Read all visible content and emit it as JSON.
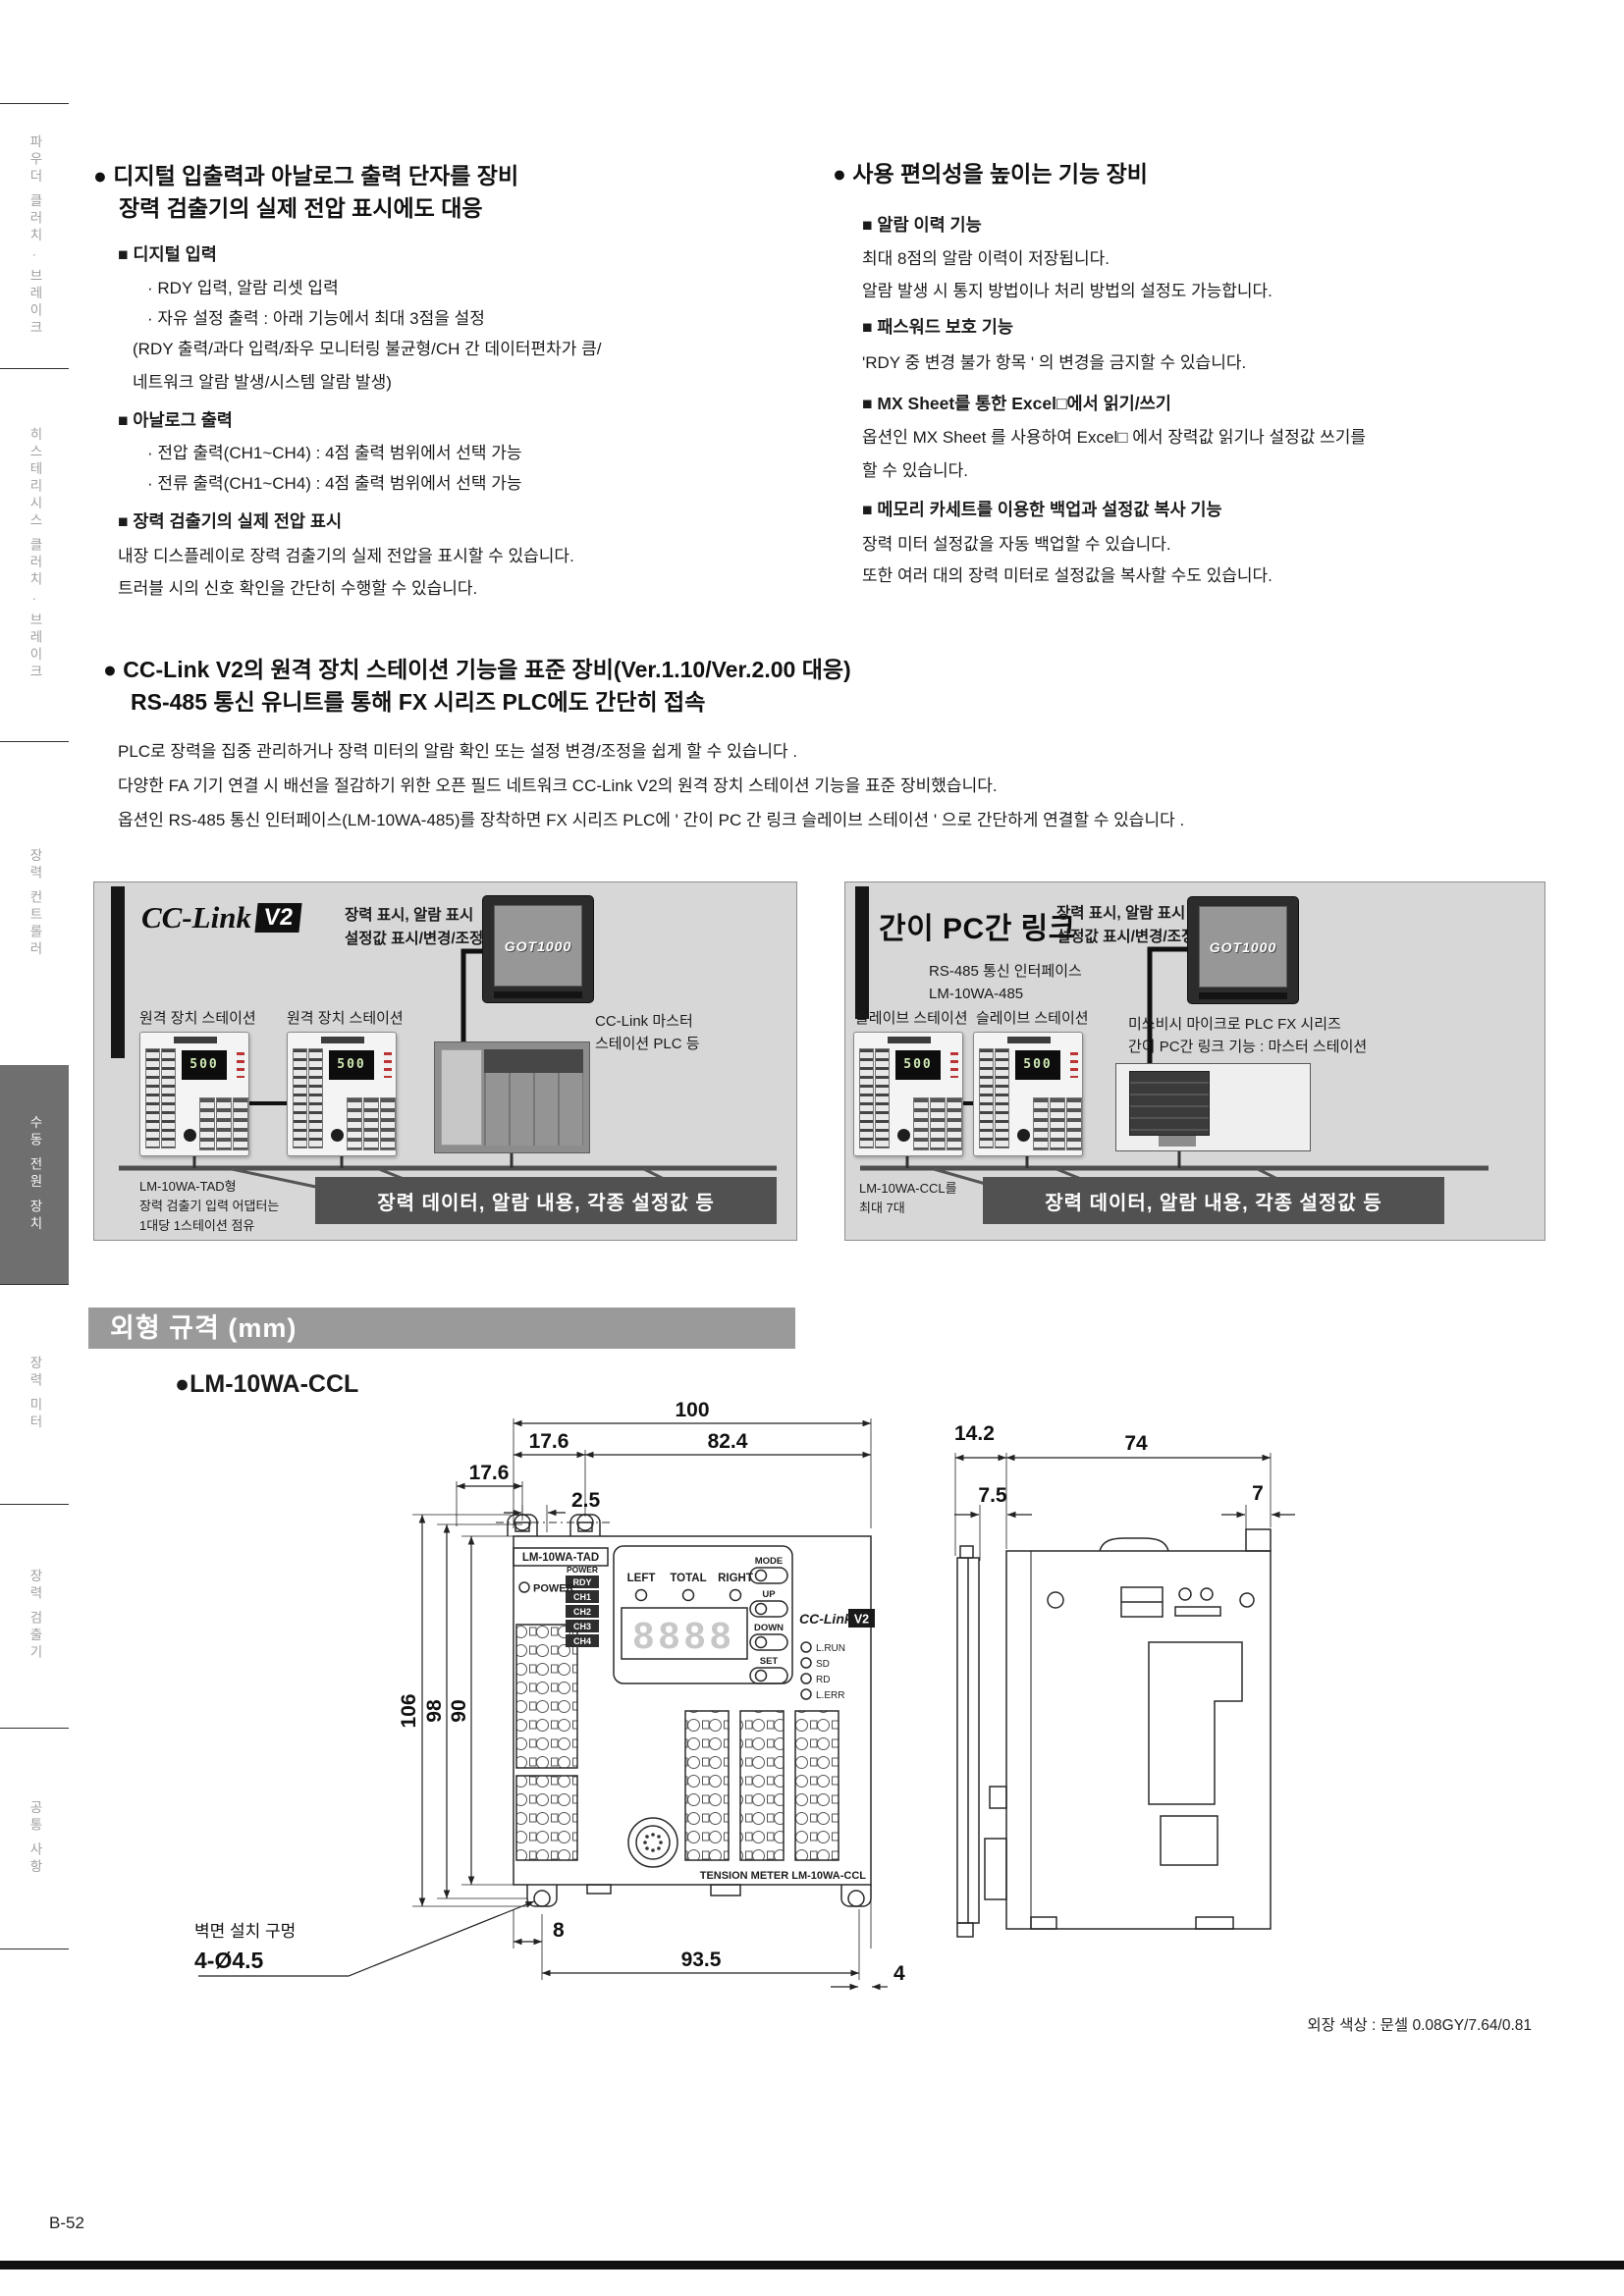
{
  "sidebar": {
    "tabs": [
      {
        "label": "파우더 클러치 · 브레이크"
      },
      {
        "label": "히스테리시스 클러치 · 브레이크"
      },
      {
        "label": "장력 컨트롤러"
      },
      {
        "label": "수동 전원 장치"
      },
      {
        "label": "장력 미터"
      },
      {
        "label": "장력 검출기"
      },
      {
        "label": "공통 사항"
      }
    ]
  },
  "features_left": {
    "title1": "● 디지털 입출력과 아날로그 출력 단자를 장비",
    "title2": "장력 검출기의 실제 전압 표시에도 대응",
    "digital_header": "■ 디지털 입력",
    "digital_item1": "· RDY 입력, 알람 리셋 입력",
    "digital_item2": "· 자유 설정 출력 : 아래 기능에서 최대 3점을 설정",
    "digital_item3": "(RDY 출력/과다 입력/좌우 모니터링 불균형/CH 간 데이터편차가 큼/",
    "digital_item4": "네트워크 알람 발생/시스템 알람 발생)",
    "analog_header": "■ 아날로그 출력",
    "analog_item1": "· 전압 출력(CH1~CH4) : 4점 출력 범위에서 선택 가능",
    "analog_item2": "· 전류 출력(CH1~CH4) : 4점 출력 범위에서 선택 가능",
    "voltage_header": "■ 장력 검출기의 실제 전압 표시",
    "voltage_line1": "내장 디스플레이로 장력 검출기의 실제 전압을 표시할 수 있습니다.",
    "voltage_line2": "트러블 시의 신호 확인을 간단히 수행할 수 있습니다."
  },
  "features_right": {
    "title": "● 사용 편의성을 높이는 기능 장비",
    "b1_header": "■ 알람 이력 기능",
    "b1_line1": "최대 8점의 알람 이력이 저장됩니다.",
    "b1_line2": "알람 발생 시 통지 방법이나 처리 방법의 설정도 가능합니다.",
    "b2_header": "■ 패스워드 보호 기능",
    "b2_line1": "'RDY 중 변경 불가 항목 ' 의 변경을 금지할 수 있습니다.",
    "b3_header": "■ MX Sheet를 통한 Excel□에서 읽기/쓰기",
    "b3_line1": "옵션인 MX Sheet 를 사용하여 Excel□ 에서 장력값 읽기나 설정값 쓰기를",
    "b3_line2": "할 수 있습니다.",
    "b4_header": "■ 메모리 카세트를 이용한 백업과 설정값 복사 기능",
    "b4_line1": "장력 미터 설정값을 자동 백업할 수 있습니다.",
    "b4_line2": "또한 여러 대의 장력 미터로 설정값을 복사할 수도 있습니다."
  },
  "cclink_section": {
    "title1": "● CC-Link V2의 원격 장치 스테이션 기능을 표준 장비(Ver.1.10/Ver.2.00 대응)",
    "title2": "RS-485 통신 유니트를 통해 FX 시리즈 PLC에도 간단히 접속",
    "p1": "PLC로 장력을 집중 관리하거나 장력 미터의 알람 확인 또는 설정 변경/조정을 쉽게 할 수 있습니다 .",
    "p2": "다양한 FA 기기 연결 시 배선을 절감하기 위한 오픈 필드 네트워크 CC-Link V2의 원격 장치 스테이션 기능을 표준 장비했습니다.",
    "p3": "옵션인 RS-485 통신 인터페이스(LM-10WA-485)를 장착하면 FX 시리즈 PLC에 ' 간이 PC 간 링크 슬레이브 스테이션 ' 으로 간단하게 연결할 수 있습니다 ."
  },
  "diagram_cclink": {
    "logo": "CC-Link",
    "logo_badge": "V2",
    "caption1": "장력 표시, 알람 표시",
    "caption2": "설정값 표시/변경/조정 등",
    "got_label": "GOT1000",
    "station1": "원격 장치 스테이션",
    "station2": "원격 장치 스테이션",
    "display": "500",
    "master1": "CC-Link 마스터",
    "master2": "스테이션 PLC 등",
    "note1": "LM-10WA-TAD형",
    "note2": "장력 검출기 입력 어댑터는",
    "note3": "1대당 1스테이션 점유",
    "banner": "장력 데이터, 알람 내용, 각종 설정값 등"
  },
  "diagram_pclink": {
    "title": "간이 PC간 링크",
    "caption1": "장력 표시, 알람 표시",
    "caption2": "설정값 표시/변경/조정 등",
    "got_label": "GOT1000",
    "interface1": "RS-485 통신 인터페이스",
    "interface2": "LM-10WA-485",
    "station1": "슬레이브 스테이션",
    "station2": "슬레이브 스테이션",
    "display": "500",
    "master1": "미쓰비시 마이크로 PLC FX 시리즈",
    "master2": "간이 PC간 링크 기능 : 마스터 스테이션",
    "note1": "LM-10WA-CCL를",
    "note2": "최대 7대",
    "banner": "장력 데이터, 알람 내용, 각종 설정값 등"
  },
  "outline": {
    "header": "외형 규격 (mm)",
    "model": "●LM-10WA-CCL",
    "front": {
      "dim_100": "100",
      "dim_176a": "17.6",
      "dim_824": "82.4",
      "dim_176b": "17.6",
      "dim_25": "2.5",
      "dim_106": "106",
      "dim_98": "98",
      "dim_90": "90",
      "dim_8": "8",
      "dim_935": "93.5",
      "dim_4": "4",
      "hole_note1": "벽면 설치 구멍",
      "hole_note2": "4-Ø4.5",
      "tag": "LM-10WA-TAD",
      "power_label": "POWER",
      "power_col": "POWER",
      "ch": [
        "RDY",
        "CH1",
        "CH2",
        "CH3",
        "CH4"
      ],
      "left": "LEFT",
      "total": "TOTAL",
      "right": "RIGHT",
      "digits": "8888",
      "buttons": [
        "MODE",
        "UP",
        "DOWN",
        "SET"
      ],
      "logo": "CC-Link",
      "logo_badge": "V2",
      "leds": [
        "L.RUN",
        "SD",
        "RD",
        "L.ERR"
      ],
      "footer_label": "TENSION METER  LM-10WA-CCL"
    },
    "side": {
      "dim_142": "14.2",
      "dim_74": "74",
      "dim_75": "7.5",
      "dim_7": "7"
    },
    "color_note": "외장 색상 : 문셀 0.08GY/7.64/0.81"
  },
  "footer": {
    "page": "B-52"
  }
}
